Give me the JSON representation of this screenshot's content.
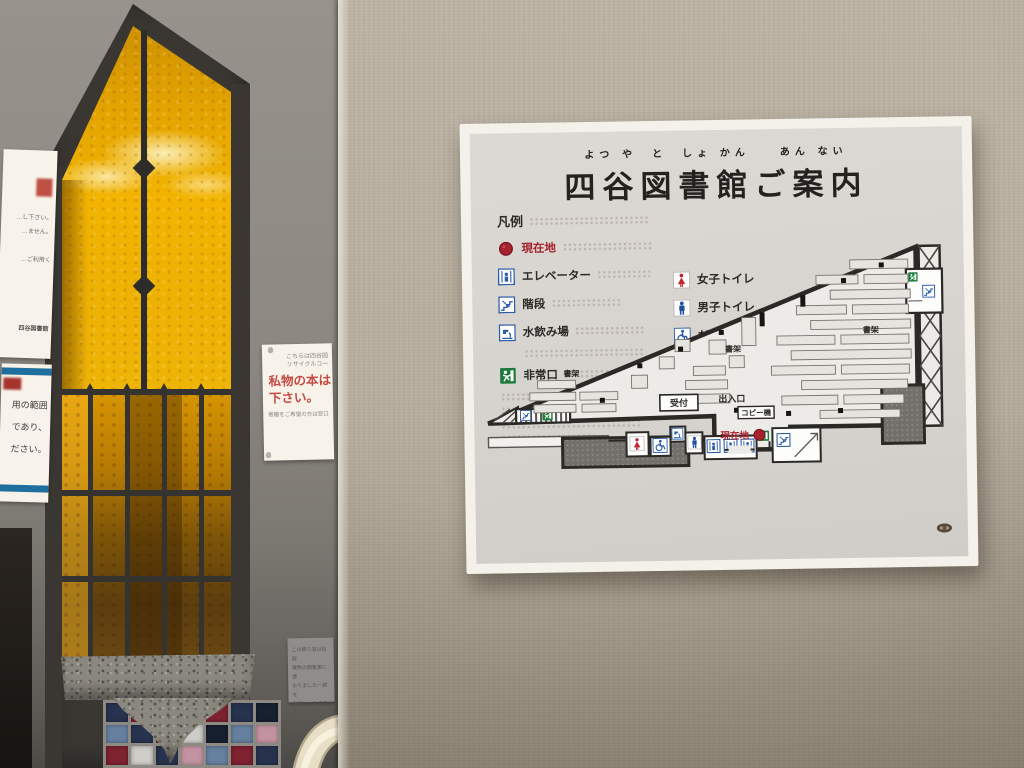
{
  "sign": {
    "title": "四谷図書館ご案内",
    "furigana": "よつ や　と　しょ かん　　あん ない",
    "legend": {
      "header": "凡例",
      "col1": [
        {
          "icon": "current-location-icon",
          "label": "現在地"
        },
        {
          "icon": "elevator-icon",
          "label": "エレベーター"
        },
        {
          "icon": "stairs-icon",
          "label": "階段"
        },
        {
          "icon": "water-fountain-icon",
          "label": "水飲み場"
        },
        {
          "icon": "emergency-exit-icon",
          "label": "非常口"
        }
      ],
      "col2": [
        {
          "icon": "womens-toilet-icon",
          "label": "女子トイレ"
        },
        {
          "icon": "mens-toilet-icon",
          "label": "男子トイレ"
        },
        {
          "icon": "accessible-toilet-icon",
          "label": "だれでもトイレ"
        }
      ]
    },
    "map": {
      "labels": {
        "shelf": "書架",
        "reception": "受付",
        "entrance": "出入口",
        "copier": "コピー機",
        "current_location": "現在地"
      }
    },
    "colors": {
      "board": "#f4f1ea",
      "panel": "#d8d5d0",
      "accent_red": "#a6232e",
      "accent_blue": "#2a5ca8",
      "accent_green": "#1d7a3b"
    }
  },
  "notices": {
    "pillar_paper": {
      "line1": "こちらは四谷図",
      "line2": "リサイクルコー",
      "red_line1": "私物の本は",
      "red_line2": "下さい。",
      "small_line": "寄贈をご希望の方は窓口"
    },
    "left_top_paper": {
      "fragment1": "…し下さい。",
      "fragment2": "…ません。",
      "fragment3": "…ご利用く",
      "footer": "四谷図書館"
    },
    "left_blue_paper": {
      "line1": "用の範囲",
      "line2": "であり、",
      "line3": "ださい。"
    },
    "plaque": {
      "line1": "この飾り窓は旧館",
      "line2": "建物の閲覧室に使",
      "line3": "おりました一部を",
      "line4": "保存したものです。"
    }
  },
  "window_area": {
    "glass_color": "#e8a200",
    "frame_color": "#3a3733",
    "tile_palette": [
      "#7e2230",
      "#27324e",
      "#66809f",
      "#c493a1",
      "#cfcdc8",
      "#394e71",
      "#17202f"
    ],
    "tile_pattern": [
      [
        1,
        0,
        4,
        2,
        0,
        1,
        6
      ],
      [
        2,
        1,
        0,
        4,
        6,
        2,
        3
      ],
      [
        0,
        4,
        1,
        3,
        2,
        0,
        1
      ]
    ]
  }
}
